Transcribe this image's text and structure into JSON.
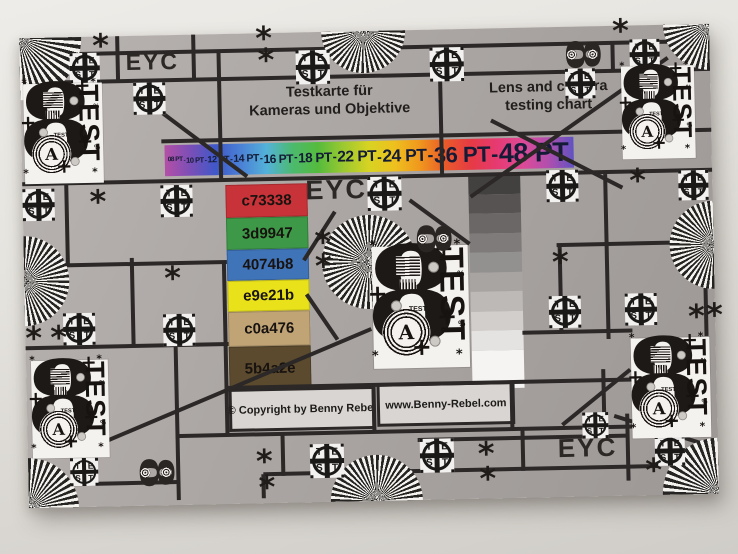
{
  "page": {
    "width": 738,
    "height": 554
  },
  "eyc": "EYC",
  "titles": {
    "de_line1": "Testkarte für",
    "de_line2": "Kameras und Objektive",
    "en_line1": "Lens and camera",
    "en_line2": "testing chart"
  },
  "footer": {
    "copyright": "© Copyright by Benny Rebel",
    "website": "www.Benny-Rebel.com"
  },
  "pt_scale": {
    "items": [
      "08 PT",
      "10 PT",
      "12 PT",
      "14 PT",
      "16 PT",
      "18 PT",
      "22 PT",
      "24 PT",
      "36 PT",
      "48 PT"
    ],
    "sizes": [
      6.5,
      7.5,
      9,
      10.5,
      12,
      13.5,
      15.5,
      17.5,
      22,
      27
    ],
    "separator": "-",
    "text_color": "#141b36",
    "gradient": [
      "#b44fa6",
      "#7b4fb7",
      "#3f58c8",
      "#4b82d6",
      "#53b2d8",
      "#4cba6e",
      "#55bb3d",
      "#9cc930",
      "#d8d322",
      "#eec01e",
      "#f0961e",
      "#e9592a",
      "#e63a45",
      "#e63a72",
      "#de4a96",
      "#b14fae",
      "#6152c2"
    ]
  },
  "color_patches": [
    {
      "label": "c73338",
      "color": "#c73338",
      "height": 33
    },
    {
      "label": "3d9947",
      "color": "#3d9947",
      "height": 32
    },
    {
      "label": "4074b8",
      "color": "#4074b8",
      "height": 31
    },
    {
      "label": "e9e21b",
      "color": "#e9e21b",
      "height": 31
    },
    {
      "label": "c0a476",
      "color": "#c0a476",
      "height": 35
    },
    {
      "label": "5b4a2e",
      "color": "#5b4a2e",
      "height": 45
    }
  ],
  "grayscale_steps": [
    {
      "color": "#434040",
      "height": 19.5
    },
    {
      "color": "#565352",
      "height": 19.5
    },
    {
      "color": "#6a6766",
      "height": 19.5
    },
    {
      "color": "#7e7b7a",
      "height": 19.5
    },
    {
      "color": "#929190",
      "height": 19.5
    },
    {
      "color": "#a7a4a2",
      "height": 19.5
    },
    {
      "color": "#bcb9b7",
      "height": 19.5
    },
    {
      "color": "#d1cecc",
      "height": 19.5
    },
    {
      "color": "#e5e3e1",
      "height": 19.5
    },
    {
      "color": "#f5f4f2",
      "height": 38.5
    }
  ],
  "glyphs": {
    "asterisk": "*",
    "plus": "+",
    "digit8": "8",
    "letterA": "A",
    "test": "TEST",
    "percent": "%",
    "crosshair_letters": [
      "T",
      "E",
      "S",
      "T"
    ]
  },
  "palette": {
    "wall_top": "#eeece8",
    "wall_bottom": "#d0cdc8",
    "chart_light": "#b8b3b1",
    "chart_dark": "#9d9896",
    "line": "#2b2827",
    "fan_dark": "#262422",
    "fan_light": "#f4f3f0",
    "target_bg": "#f4f2ef",
    "ink": "#1c1916",
    "footer_bg": "#d8d5d2",
    "eyc_color": "#2b2826"
  },
  "layout": {
    "hlines": [
      [
        17,
        48,
        690
      ],
      [
        45,
        0,
        690
      ],
      [
        106,
        140,
        690
      ],
      [
        146,
        0,
        690
      ],
      [
        218,
        533,
        690
      ],
      [
        228,
        0,
        203
      ],
      [
        305,
        497,
        607
      ],
      [
        310,
        0,
        203
      ],
      [
        354,
        198,
        607
      ],
      [
        401,
        148,
        607
      ],
      [
        410,
        390,
        600
      ],
      [
        441,
        235,
        629
      ],
      [
        447,
        28,
        150
      ]
    ],
    "vlines": [
      [
        51,
        0,
        17
      ],
      [
        98,
        0,
        45
      ],
      [
        174,
        0,
        45
      ],
      [
        199,
        16,
        146
      ],
      [
        420,
        16,
        146
      ],
      [
        635,
        17,
        106
      ],
      [
        593,
        17,
        45
      ],
      [
        44,
        146,
        228
      ],
      [
        108,
        222,
        310
      ],
      [
        200,
        228,
        400
      ],
      [
        536,
        218,
        305
      ],
      [
        583,
        148,
        313
      ],
      [
        681,
        264,
        312
      ],
      [
        347,
        354,
        400
      ],
      [
        485,
        354,
        400
      ],
      [
        150,
        310,
        465
      ],
      [
        235,
        441,
        465
      ],
      [
        255,
        401,
        443
      ],
      [
        495,
        401,
        443
      ],
      [
        600,
        388,
        455
      ],
      [
        577,
        343,
        401
      ]
    ],
    "diagonals": [
      [
        142,
        78,
        225,
        143
      ],
      [
        648,
        33,
        448,
        168
      ],
      [
        470,
        92,
        600,
        162
      ],
      [
        312,
        180,
        280,
        228
      ],
      [
        282,
        262,
        312,
        308
      ],
      [
        387,
        170,
        446,
        215
      ],
      [
        346,
        298,
        75,
        406
      ],
      [
        604,
        344,
        535,
        398
      ],
      [
        587,
        390,
        688,
        424
      ],
      [
        606,
        410,
        650,
        390
      ]
    ],
    "crosshairs": [
      [
        50,
        16,
        30
      ],
      [
        113,
        47,
        32
      ],
      [
        276,
        18,
        34
      ],
      [
        410,
        18,
        34
      ],
      [
        545,
        42,
        30
      ],
      [
        610,
        14,
        30
      ],
      [
        0,
        151,
        32
      ],
      [
        138,
        150,
        32
      ],
      [
        345,
        146,
        34
      ],
      [
        524,
        143,
        32
      ],
      [
        656,
        146,
        30
      ],
      [
        524,
        269,
        32
      ],
      [
        600,
        268,
        32
      ],
      [
        38,
        276,
        32
      ],
      [
        138,
        279,
        32
      ],
      [
        282,
        412,
        34
      ],
      [
        392,
        409,
        34
      ],
      [
        627,
        411,
        30
      ],
      [
        42,
        421,
        28
      ],
      [
        555,
        386,
        26
      ]
    ],
    "asterisks": [
      [
        73,
        0
      ],
      [
        236,
        -4
      ],
      [
        238,
        18
      ],
      [
        67,
        156
      ],
      [
        140,
        234
      ],
      [
        291,
        201
      ],
      [
        291,
        225
      ],
      [
        0,
        291
      ],
      [
        25,
        291
      ],
      [
        528,
        226
      ],
      [
        593,
        -4
      ],
      [
        607,
        146
      ],
      [
        663,
        283
      ],
      [
        681,
        282
      ],
      [
        228,
        419
      ],
      [
        230,
        445
      ],
      [
        450,
        416
      ],
      [
        451,
        441
      ],
      [
        617,
        436
      ]
    ],
    "fans": [
      {
        "t": "tl",
        "r": 62
      },
      {
        "t": "tr",
        "r": 46
      },
      {
        "t": "bl",
        "r": 50
      },
      {
        "t": "br",
        "r": 56
      },
      {
        "t": "top",
        "x": 344,
        "r": 42
      },
      {
        "t": "bottom",
        "x": 348,
        "r": 46
      },
      {
        "t": "left",
        "y": 243,
        "r": 45
      },
      {
        "t": "right",
        "y": 221,
        "r": 44
      },
      {
        "t": "full",
        "x": 345,
        "y": 231,
        "r": 47,
        "step": 3.6
      }
    ],
    "targets": [
      [
        3,
        46,
        0.82
      ],
      [
        601,
        41,
        0.76
      ],
      [
        348,
        216,
        1
      ],
      [
        5,
        323,
        0.8
      ],
      [
        605,
        313,
        0.82
      ]
    ],
    "small_targets": [
      [
        538,
        12
      ],
      [
        385,
        193
      ],
      [
        103,
        421
      ]
    ],
    "ptbar": {
      "x": 143,
      "y": 110,
      "w": 409,
      "h": 31
    },
    "patches_col": {
      "x": 203,
      "y": 151,
      "w": 82
    },
    "wedge_col": {
      "x": 446,
      "y": 146,
      "w": 52
    }
  }
}
